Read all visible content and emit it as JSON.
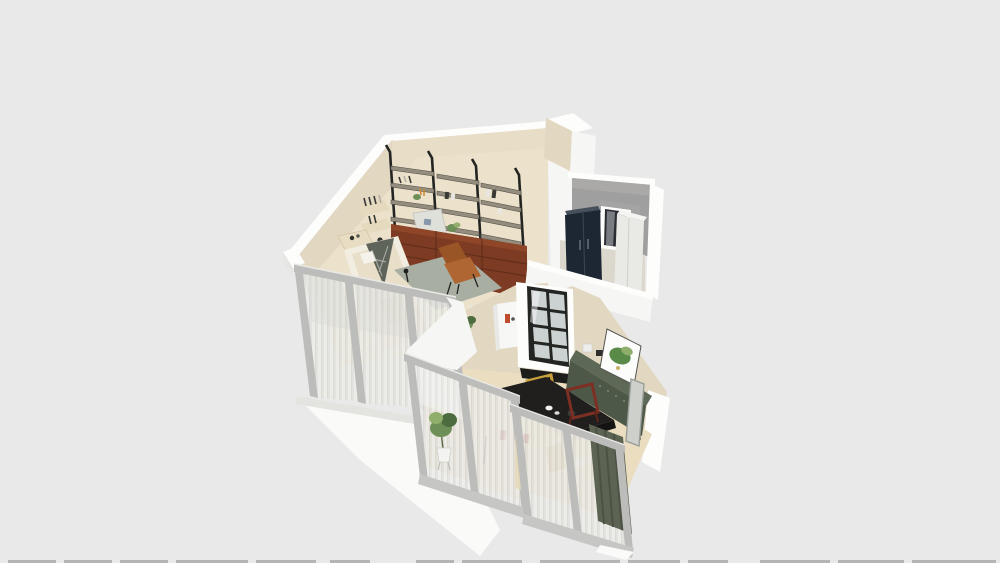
{
  "scene": {
    "type": "3d-floorplan-perspective-render",
    "inventory": {
      "living_area": [
        "wall-shelf-unit",
        "mahogany-base-cabinets",
        "wall-book-shelves",
        "platform-bed",
        "canopy-tent",
        "area-rug",
        "leather-lounge-chair",
        "bedside-table",
        "floor-lamp"
      ],
      "utility_room": [
        "concrete-accent-wall",
        "navy-wardrobe",
        "window",
        "white-refrigerator"
      ],
      "dining_area": [
        "glass-panel-door",
        "white-wall-shelf",
        "green-sideboard",
        "botanical-artwork",
        "leaning-mirror",
        "dining-table",
        "yellow-frame-chair",
        "maroon-frame-chair",
        "olive-curtain"
      ],
      "exterior": [
        "sliding-glass-doors",
        "sheer-curtains",
        "potted-plant",
        "white-floor-slab"
      ]
    }
  },
  "colors": {
    "background": "#e9e9e9",
    "wall_white": "#f6f6f4",
    "wall_white_bright": "#fdfdfc",
    "wall_beige": "#e2d7c1",
    "wall_beige_light": "#e8ddc7",
    "floor_living": "#ece2cc",
    "floor_dining": "#eaddc0",
    "concrete": "#9f9f9f",
    "concrete_light": "#b5b4b2",
    "navy_cabinet": "#1d2733",
    "navy_cabinet_top": "#46505c",
    "white_appliance": "#e9eae6",
    "window_dark": "#2b2f33",
    "glass": "#ccd1d2",
    "frame_black": "#232523",
    "shelf_gray": "#948d7d",
    "shelf_edge": "#55504a",
    "cabinet_mahogany": "#7c3b22",
    "cabinet_mahogany_top": "#8f4527",
    "cabinet_mahogany_dark": "#5e2c18",
    "leather_chair": "#b06632",
    "leather_chair_dark": "#9a5527",
    "bed_cream": "#e9dfc8",
    "bed_frame_white": "#f1ede1",
    "teepee_gray": "#5f645b",
    "rug": "#a9aea3",
    "door_frame_gray": "#bcbdba",
    "door_frame_gray_dark": "#c6c7c4",
    "sheer_light": "#ededea",
    "sheer_mid": "#e3e2de",
    "sheer_dark": "#d9d8d3",
    "olive_curtain": "#5c6353",
    "olive_curtain_dark": "#4b5244",
    "sideboard_green": "#4d5849",
    "sideboard_green_top": "#5d6857",
    "table_dark": "#201f1d",
    "frame_yellow": "#c7a03c",
    "chair_maroon": "#7d2f23",
    "plant_green": "#6f8f58",
    "plant_green_dark": "#4c6b3e",
    "plant_green_light": "#8fae6b",
    "art_green": "#5a8a48",
    "slab_white": "#fafaf9",
    "bottom_dash": "#ababab"
  }
}
